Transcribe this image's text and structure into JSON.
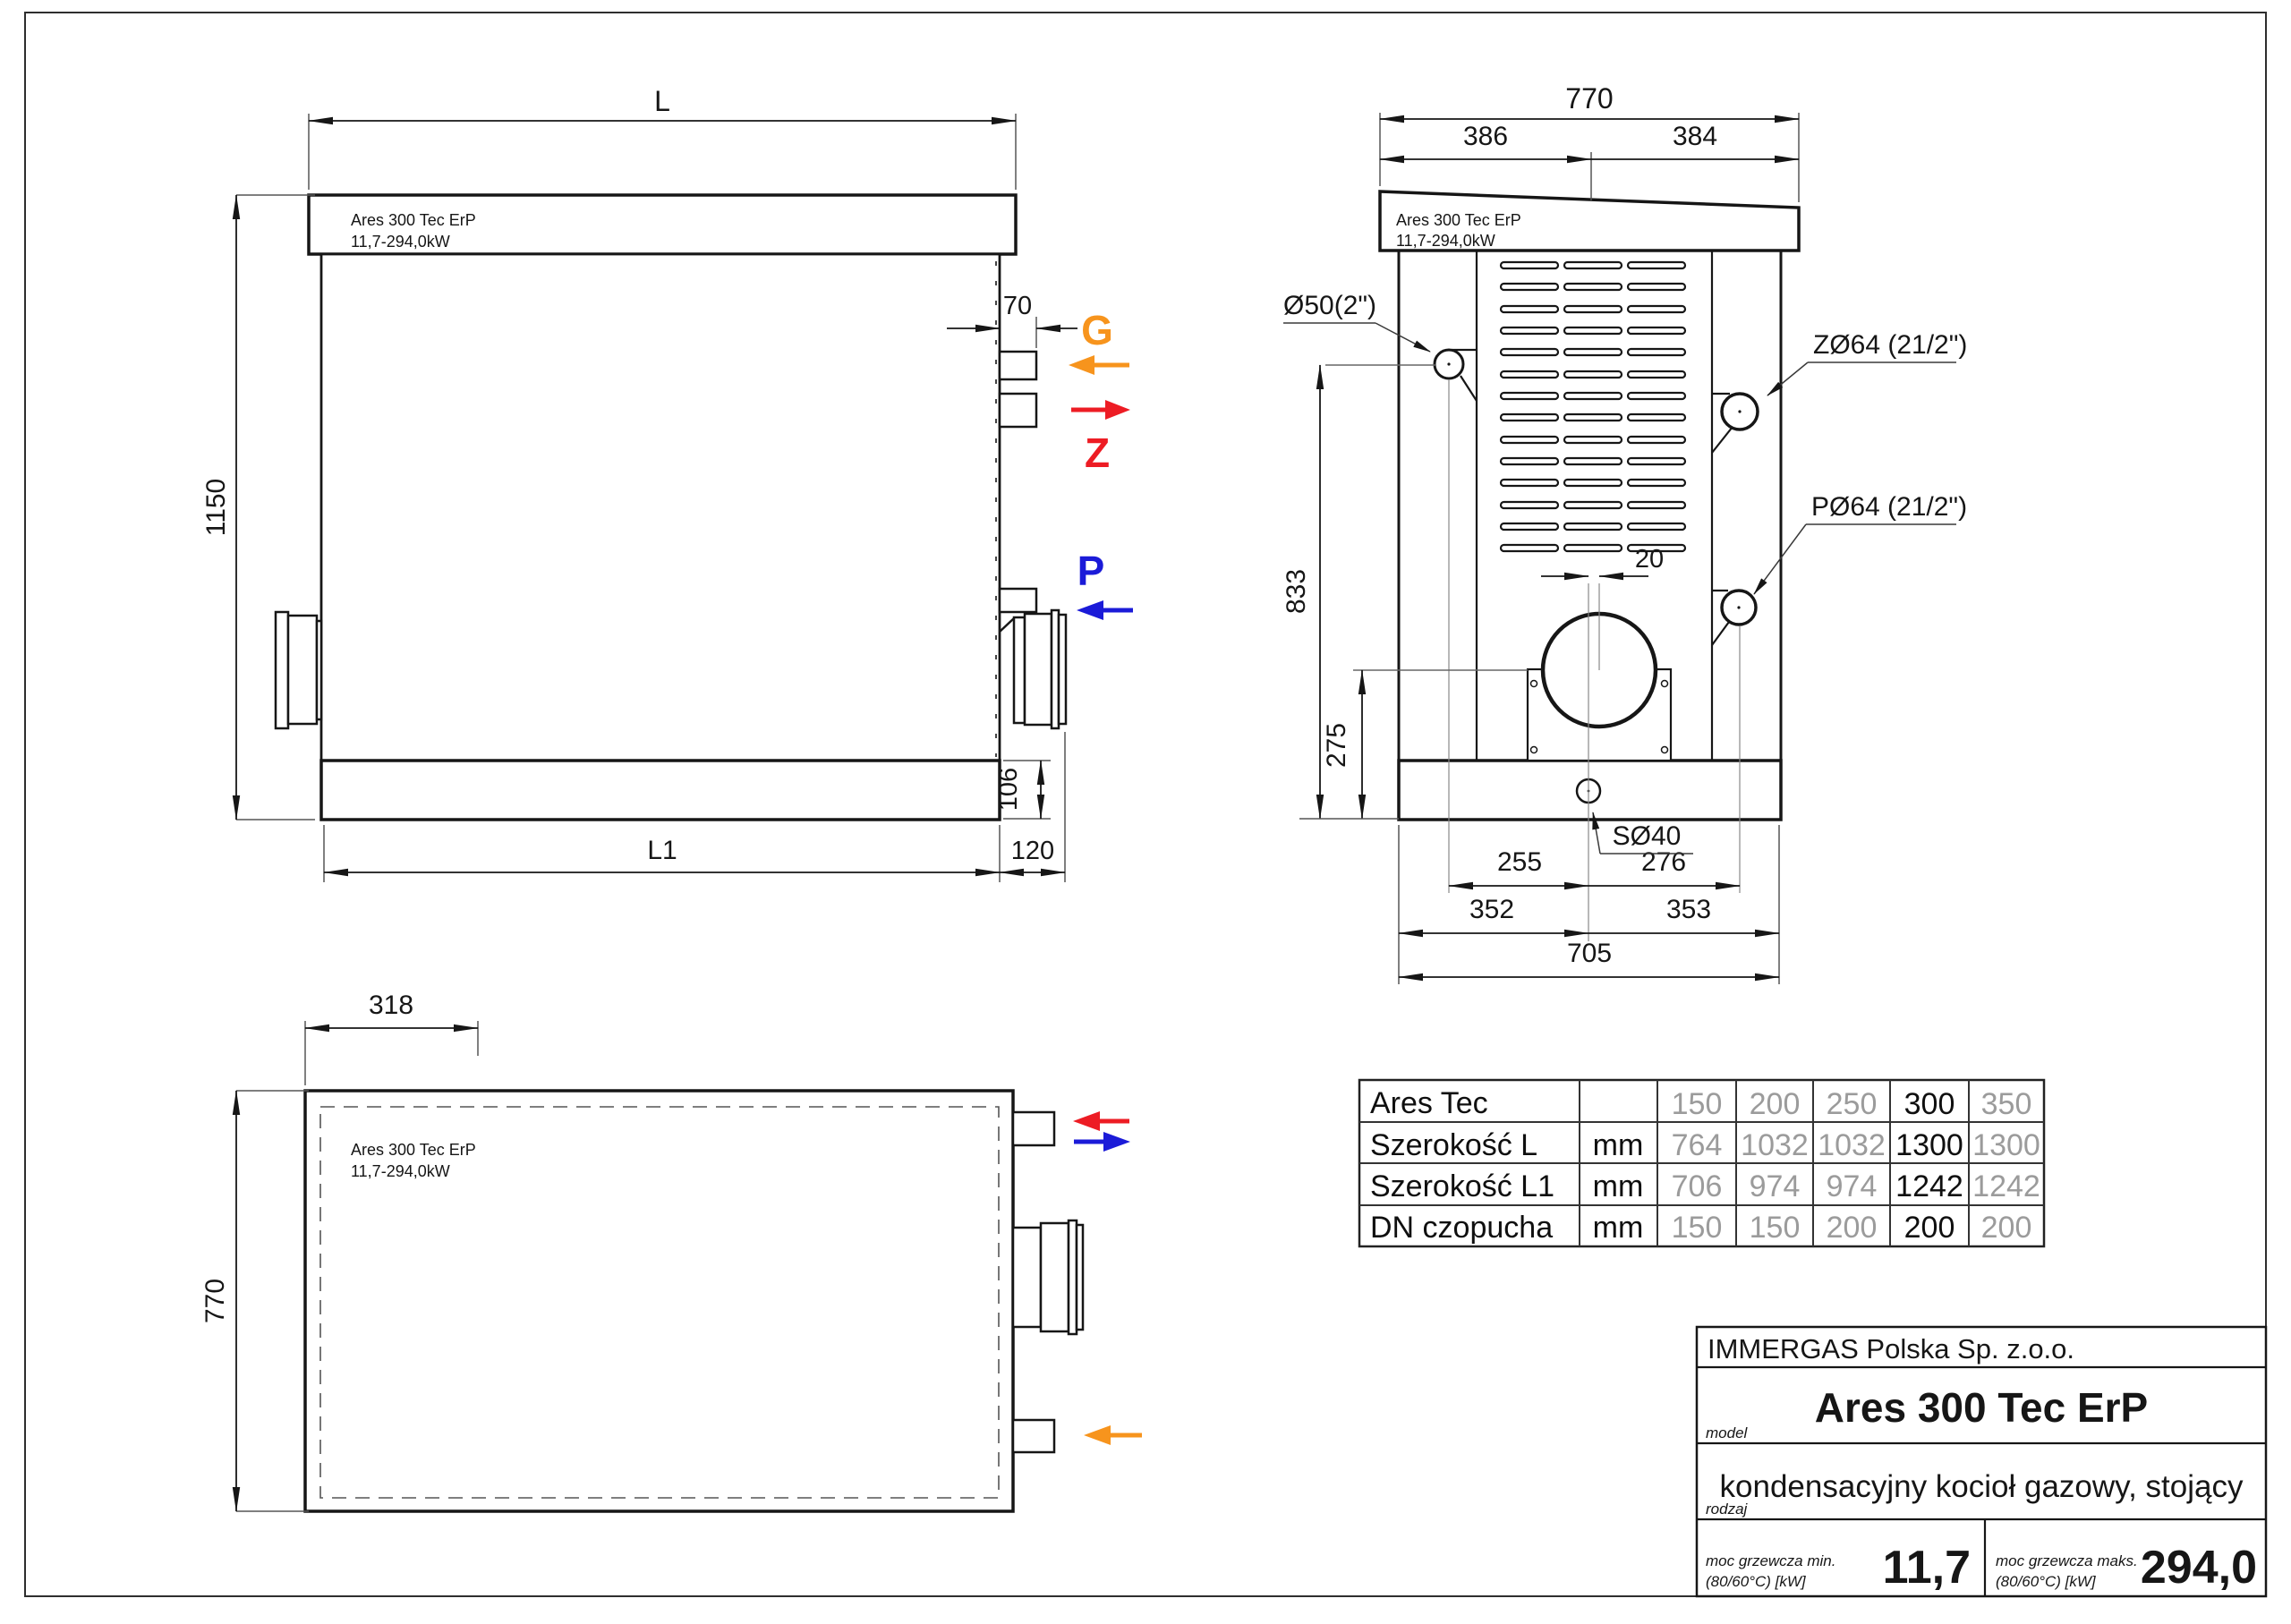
{
  "colors": {
    "line": "#161616",
    "gas_orange": "#f7941d",
    "supply_red": "#ed1c24",
    "return_blue": "#1b1bd8",
    "table_gray": "#9b9b9b"
  },
  "unit_label": {
    "line1": "Ares 300 Tec ErP",
    "line2": "11,7-294,0kW"
  },
  "side_view": {
    "dim_L": "L",
    "dim_height": "1150",
    "dim_70": "70",
    "dim_106": "106",
    "dim_L1": "L1",
    "dim_120": "120",
    "port_g": "G",
    "port_z": "Z",
    "port_p": "P"
  },
  "front_view": {
    "dim_770": "770",
    "dim_386": "386",
    "dim_384": "384",
    "dim_20": "20",
    "dim_833": "833",
    "dim_275": "275",
    "dim_255": "255",
    "dim_276": "276",
    "dim_352": "352",
    "dim_353": "353",
    "dim_705": "705",
    "label_gas": "Ø50(2\")",
    "label_z": "ZØ64 (21/2\")",
    "label_p": "PØ64 (21/2\")",
    "label_drain": "SØ40"
  },
  "top_view": {
    "dim_318": "318",
    "dim_770": "770"
  },
  "table": {
    "header_label": "Ares Tec",
    "unit": "mm",
    "models": [
      "150",
      "200",
      "250",
      "300",
      "350"
    ],
    "rows": [
      {
        "label": "Szerokość L",
        "unit": "mm",
        "values": [
          "764",
          "1032",
          "1032",
          "1300",
          "1300"
        ]
      },
      {
        "label": "Szerokość L1",
        "unit": "mm",
        "values": [
          "706",
          "974",
          "974",
          "1242",
          "1242"
        ]
      },
      {
        "label": "DN czopucha",
        "unit": "mm",
        "values": [
          "150",
          "150",
          "200",
          "200",
          "200"
        ]
      }
    ],
    "highlighted_model": "300"
  },
  "title_block": {
    "company": "IMMERGAS Polska Sp. z.o.o.",
    "model_label": "model",
    "model_value": "Ares 300 Tec ErP",
    "type_label": "rodzaj",
    "type_value": "kondensacyjny kocioł gazowy, stojący",
    "power_min_label": "moc grzewcza min.",
    "power_min_sub": "(80/60°C) [kW]",
    "power_min_value": "11,7",
    "power_max_label": "moc grzewcza maks.",
    "power_max_sub": "(80/60°C) [kW]",
    "power_max_value": "294,0"
  }
}
